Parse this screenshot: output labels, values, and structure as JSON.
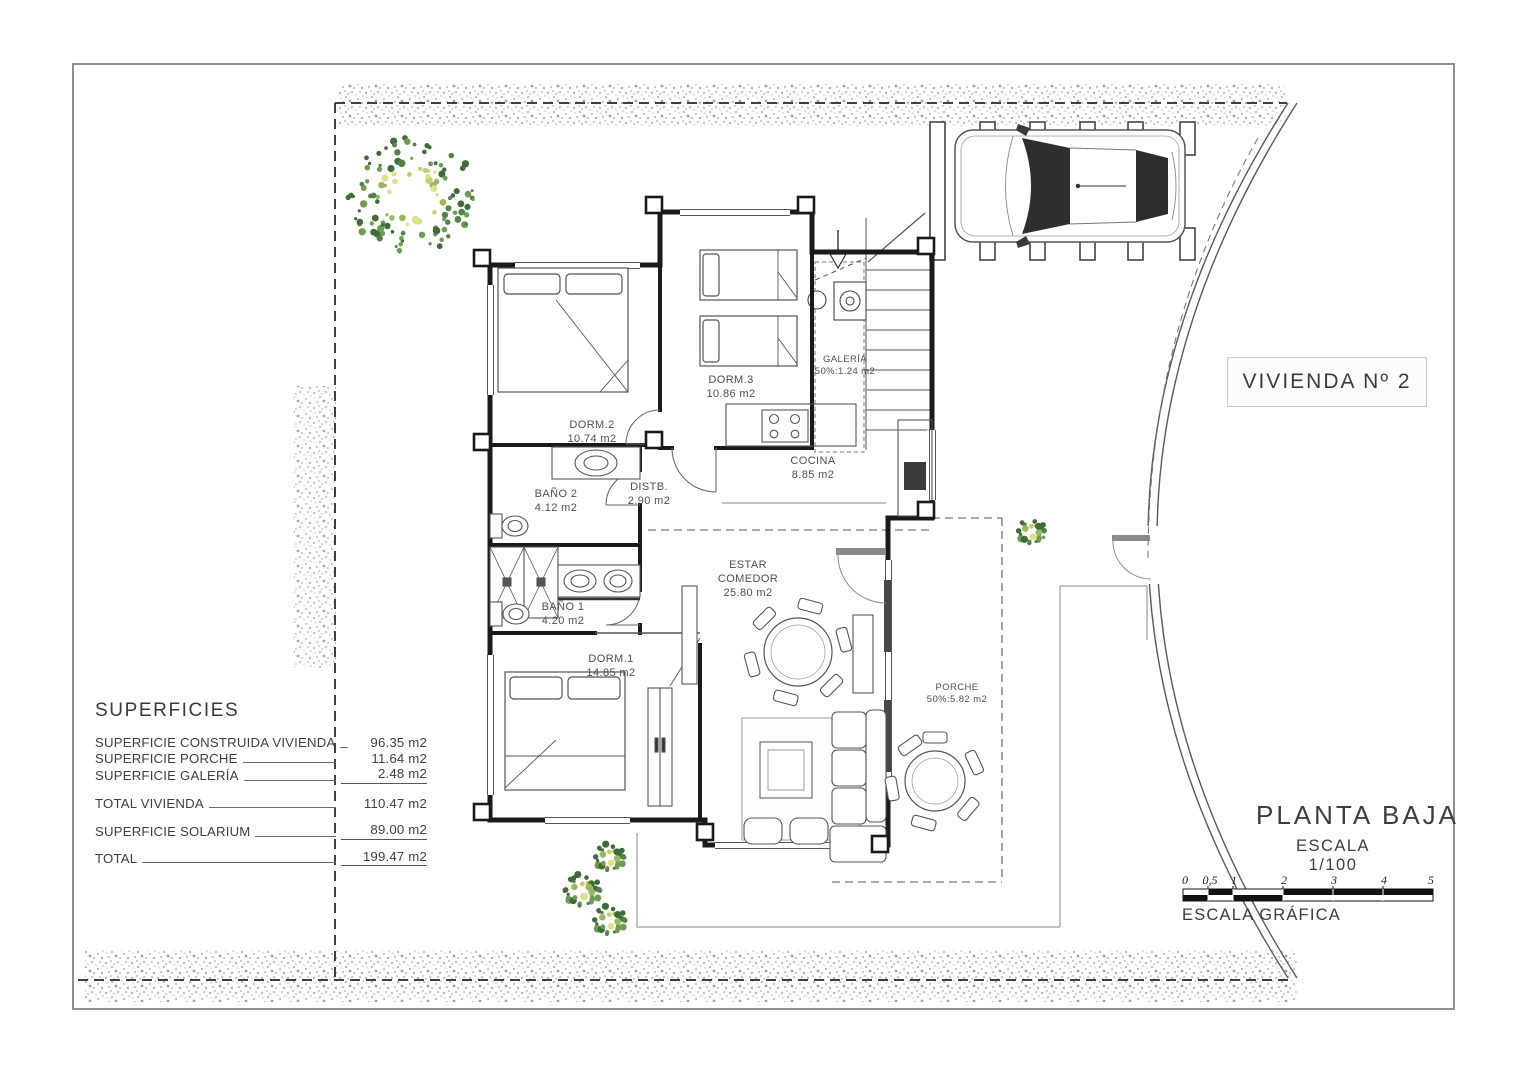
{
  "title_block": {
    "vivienda": "VIVIENDA Nº 2",
    "planta": "PLANTA BAJA",
    "escala": "ESCALA 1/100",
    "escala_grafica": "ESCALA GRÁFICA"
  },
  "scalebar": {
    "ticks": [
      "0",
      "0,5",
      "1",
      "2",
      "3",
      "4",
      "5"
    ]
  },
  "superficies": {
    "heading": "SUPERFICIES",
    "rows": [
      {
        "label": "SUPERFICIE CONSTRUIDA VIVIENDA",
        "value": "96.35 m2"
      },
      {
        "label": "SUPERFICIE PORCHE",
        "value": "11.64 m2"
      },
      {
        "label": "SUPERFICIE GALERÍA",
        "value": "2.48 m2"
      },
      {
        "label": "TOTAL VIVIENDA",
        "value": "110.47 m2"
      },
      {
        "label": "SUPERFICIE SOLARIUM",
        "value": "89.00 m2"
      },
      {
        "label": "TOTAL",
        "value": "199.47 m2"
      }
    ]
  },
  "rooms": {
    "dorm2": {
      "name": "DORM.2",
      "area": "10.74 m2"
    },
    "dorm3": {
      "name": "DORM.3",
      "area": "10.86 m2"
    },
    "galeria": {
      "name": "GALERÍA",
      "area": "50%:1.24 m2"
    },
    "cocina": {
      "name": "COCINA",
      "area": "8.85 m2"
    },
    "bano2": {
      "name": "BAÑO 2",
      "area": "4.12 m2"
    },
    "distb": {
      "name": "DISTB.",
      "area": "2.90 m2"
    },
    "bano1": {
      "name": "BAÑO 1",
      "area": "4.20 m2"
    },
    "dorm1": {
      "name": "DORM.1",
      "area": "14.85 m2"
    },
    "estar": {
      "name1": "ESTAR",
      "name2": "COMEDOR",
      "area": "25.80 m2"
    },
    "porche": {
      "name": "PORCHE",
      "area": "50%:5.82 m2"
    }
  },
  "colors": {
    "paper": "#ffffff",
    "border": "#8f8f8f",
    "wall": "#1a1a1a",
    "thin_line": "#555555",
    "hedge": "#9fb8a8",
    "tree_palette": [
      "#3f6b39",
      "#55804a",
      "#6f9b55",
      "#9ab95f",
      "#c2cf6d",
      "#dcdf8d"
    ]
  }
}
